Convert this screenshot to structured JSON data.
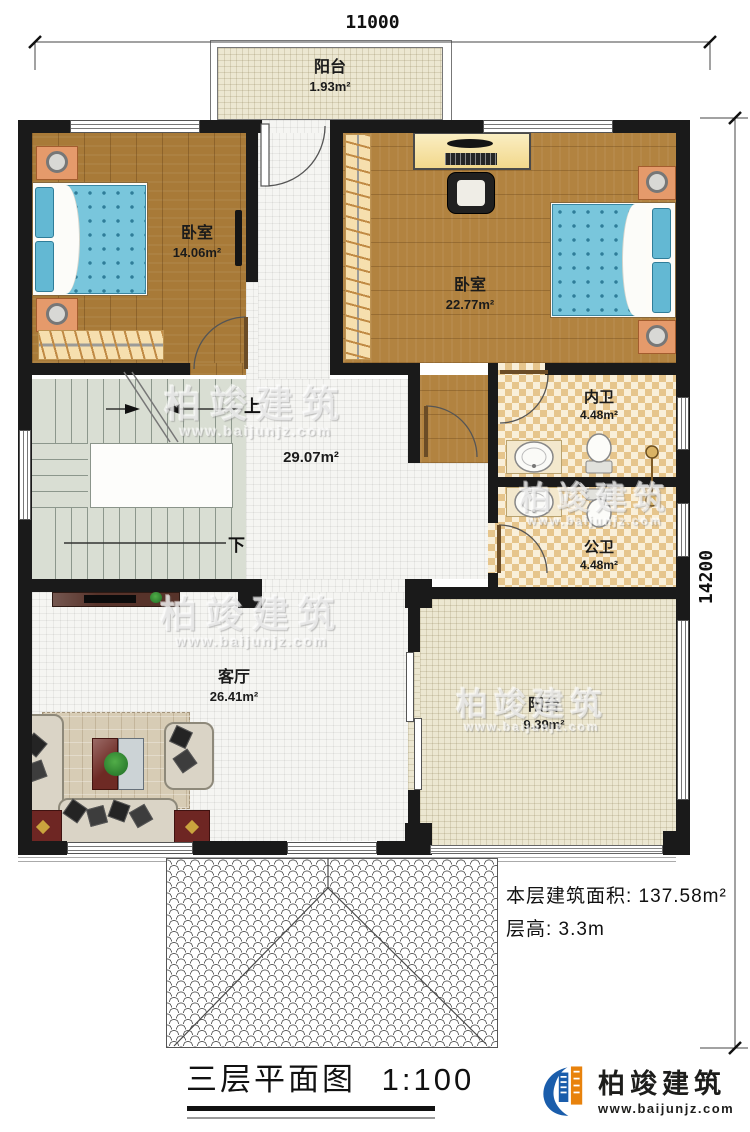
{
  "dimensions": {
    "top": "11000",
    "right": "14200"
  },
  "rooms": {
    "balcony_top": {
      "name": "阳台",
      "area": "1.93m²"
    },
    "bedroom_left": {
      "name": "卧室",
      "area": "14.06m²"
    },
    "bedroom_right": {
      "name": "卧室",
      "area": "22.77m²"
    },
    "bath_inner": {
      "name": "内卫",
      "area": "4.48m²"
    },
    "bath_public": {
      "name": "公卫",
      "area": "4.48m²"
    },
    "hall": {
      "area": "29.07m²"
    },
    "living_room": {
      "name": "客厅",
      "area": "26.41m²"
    },
    "balcony_bottom": {
      "name": "阳台",
      "area": "9.39m²"
    }
  },
  "stairs": {
    "up_label": "上",
    "down_label": "下"
  },
  "notes": {
    "floor_area": "本层建筑面积: 137.58m²",
    "floor_height": "层高: 3.3m"
  },
  "title": {
    "name": "三层平面图",
    "scale": "1:100"
  },
  "logo": {
    "name": "柏竣建筑",
    "url": "www.baijunjz.com"
  },
  "watermark": {
    "name": "柏竣建筑",
    "url": "www.baijunjz.com"
  },
  "colors": {
    "wall": "#1a1a1a",
    "wood_floor": "#b28340",
    "bed_blue": "#79c6dc",
    "bath_tile": "#e6c58c",
    "balcony_tile": "#ece7d1",
    "stair_gray": "#d9ded3",
    "logo_blue": "#1a5dab"
  }
}
